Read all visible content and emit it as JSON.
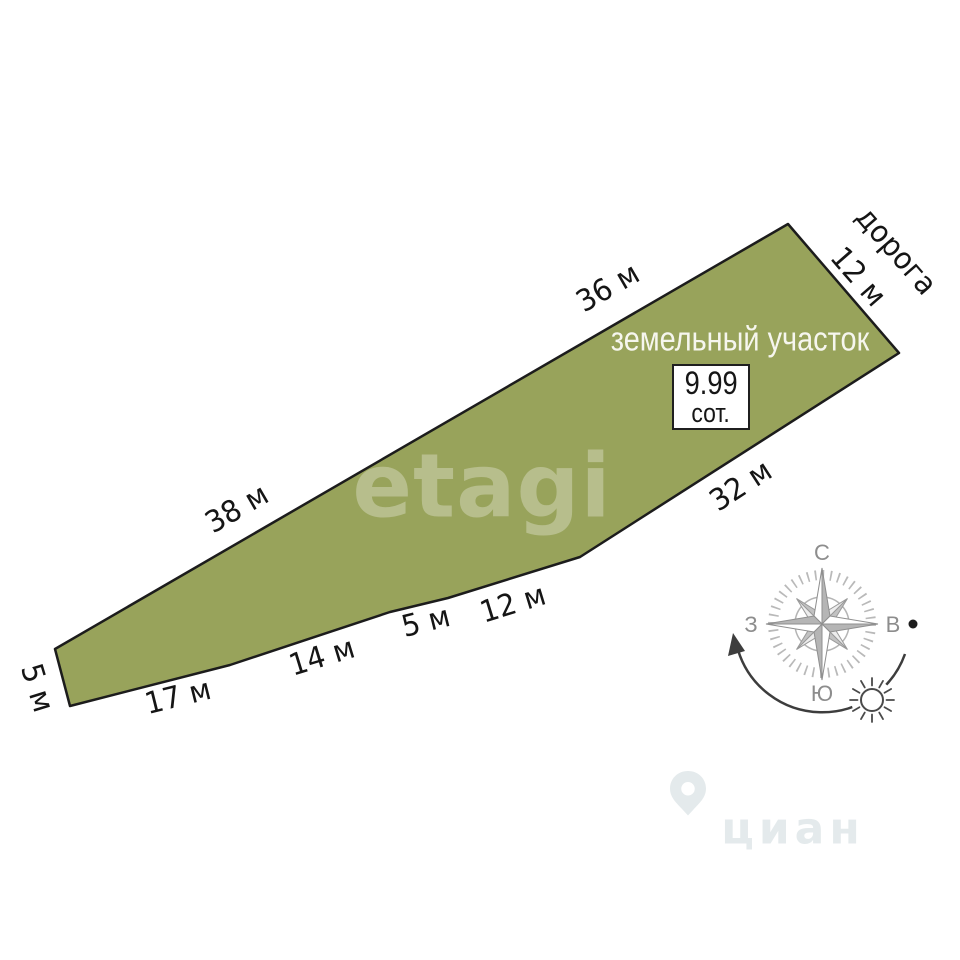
{
  "plot": {
    "name_label": "земельный участок",
    "area": {
      "value": "9.99",
      "unit": "сот."
    },
    "road_label": "дорога",
    "edges": {
      "top_west": "38 м",
      "top_east": "36 м",
      "road_frontage": "12 м",
      "southeast": "32 м",
      "bottom_east": "12 м",
      "bottom_short": "5 м",
      "bottom_mid": "14 м",
      "bottom_west": "17 м",
      "west_end": "5 м"
    },
    "fill_color": "#98a35b",
    "outline_color": "#1c1c1c"
  },
  "compass": {
    "north_label": "С",
    "east_label": "В",
    "south_label": "Ю",
    "west_label": "З"
  },
  "watermarks": {
    "etagi": "etagi",
    "cian": "циан"
  }
}
